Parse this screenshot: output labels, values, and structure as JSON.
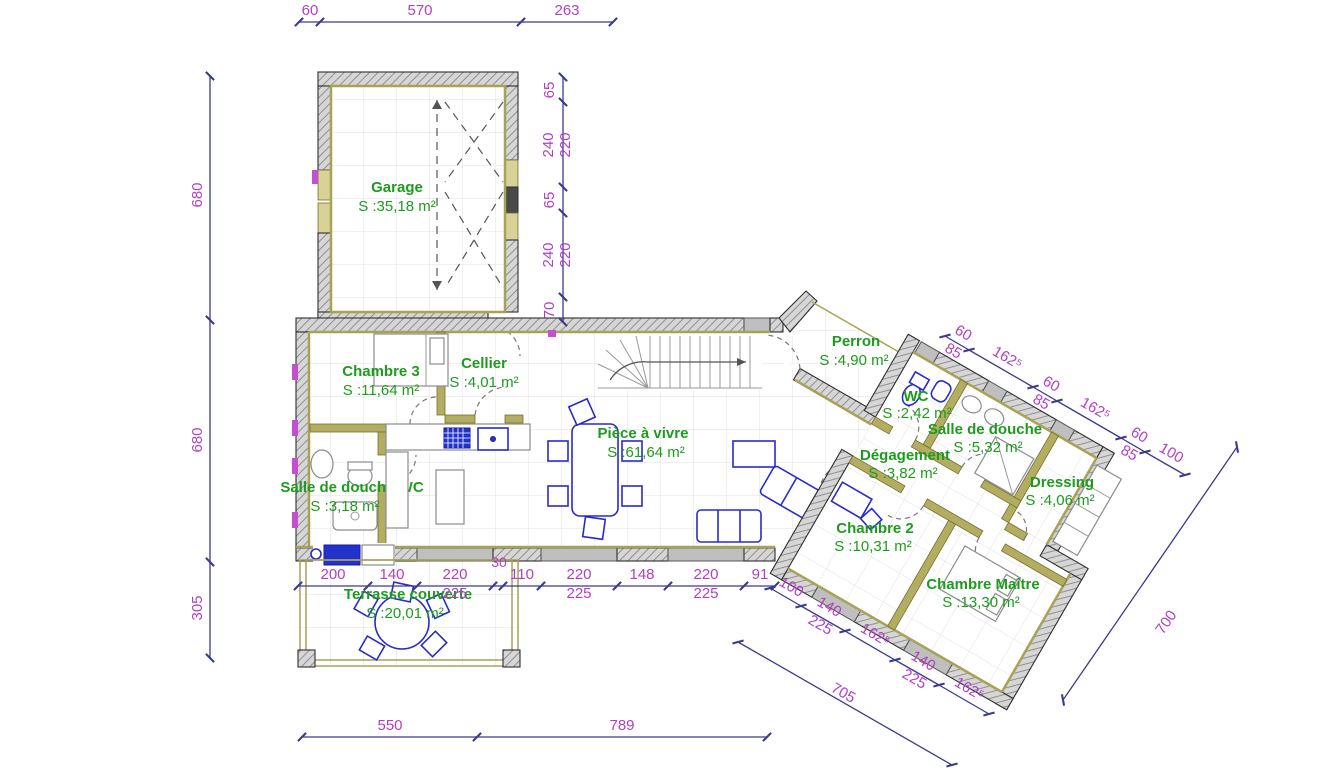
{
  "plan": {
    "rooms": {
      "garage": {
        "name": "Garage",
        "area": "S :35,18 m²"
      },
      "chambre3": {
        "name": "Chambre 3",
        "area": "S :11,64 m²"
      },
      "cellier": {
        "name": "Cellier",
        "area": "S :4,01 m²"
      },
      "piece_a_vivre": {
        "name": "Pièce à vivre",
        "area": "S :61,64 m²"
      },
      "sddwc": {
        "name": "Salle de douche WC",
        "area": "S :3,18 m²"
      },
      "terrasse": {
        "name": "Terrasse couverte",
        "area": "S :20,01 m²"
      },
      "perron": {
        "name": "Perron",
        "area": "S :4,90 m²"
      },
      "wc": {
        "name": "WC",
        "area": "S :2,42 m²"
      },
      "salle_de_douche": {
        "name": "Salle de douche",
        "area": "S :5,32 m²"
      },
      "degagement": {
        "name": "Dégagement",
        "area": "S :3,82 m²"
      },
      "dressing": {
        "name": "Dressing",
        "area": "S :4,06 m²"
      },
      "chambre2": {
        "name": "Chambre 2",
        "area": "S :10,31 m²"
      },
      "chambre_maitre": {
        "name": "Chambre Maître",
        "area": "S :13,30 m²"
      }
    },
    "dims": {
      "top": [
        "60",
        "570",
        "263"
      ],
      "left": [
        "680",
        "680",
        "305"
      ],
      "garage_right": [
        "65",
        "240",
        "220",
        "65",
        "240",
        "220",
        "70"
      ],
      "south": [
        "200",
        "140",
        "220",
        "225",
        "30",
        "110",
        "220",
        "225",
        "148",
        "220",
        "225",
        "91"
      ],
      "bottom": [
        "550",
        "789"
      ],
      "wing_top": [
        "60",
        "85",
        "162⁵",
        "60",
        "85",
        "162⁵",
        "60",
        "85",
        "100"
      ],
      "wing_bottom": [
        "100",
        "140",
        "225",
        "162⁵",
        "140",
        "225",
        "162⁵"
      ],
      "wing_total": "705",
      "right_total": "700"
    },
    "colors": {
      "room_label_green": "#1E9B1E",
      "dimension_purple": "#B13FC4",
      "dimension_line_navy": "#3B3B8E",
      "furniture_blue": "#2A2ACC",
      "partition_olive": "#B3AD62",
      "wall_gray": "#BFBFBF"
    }
  }
}
